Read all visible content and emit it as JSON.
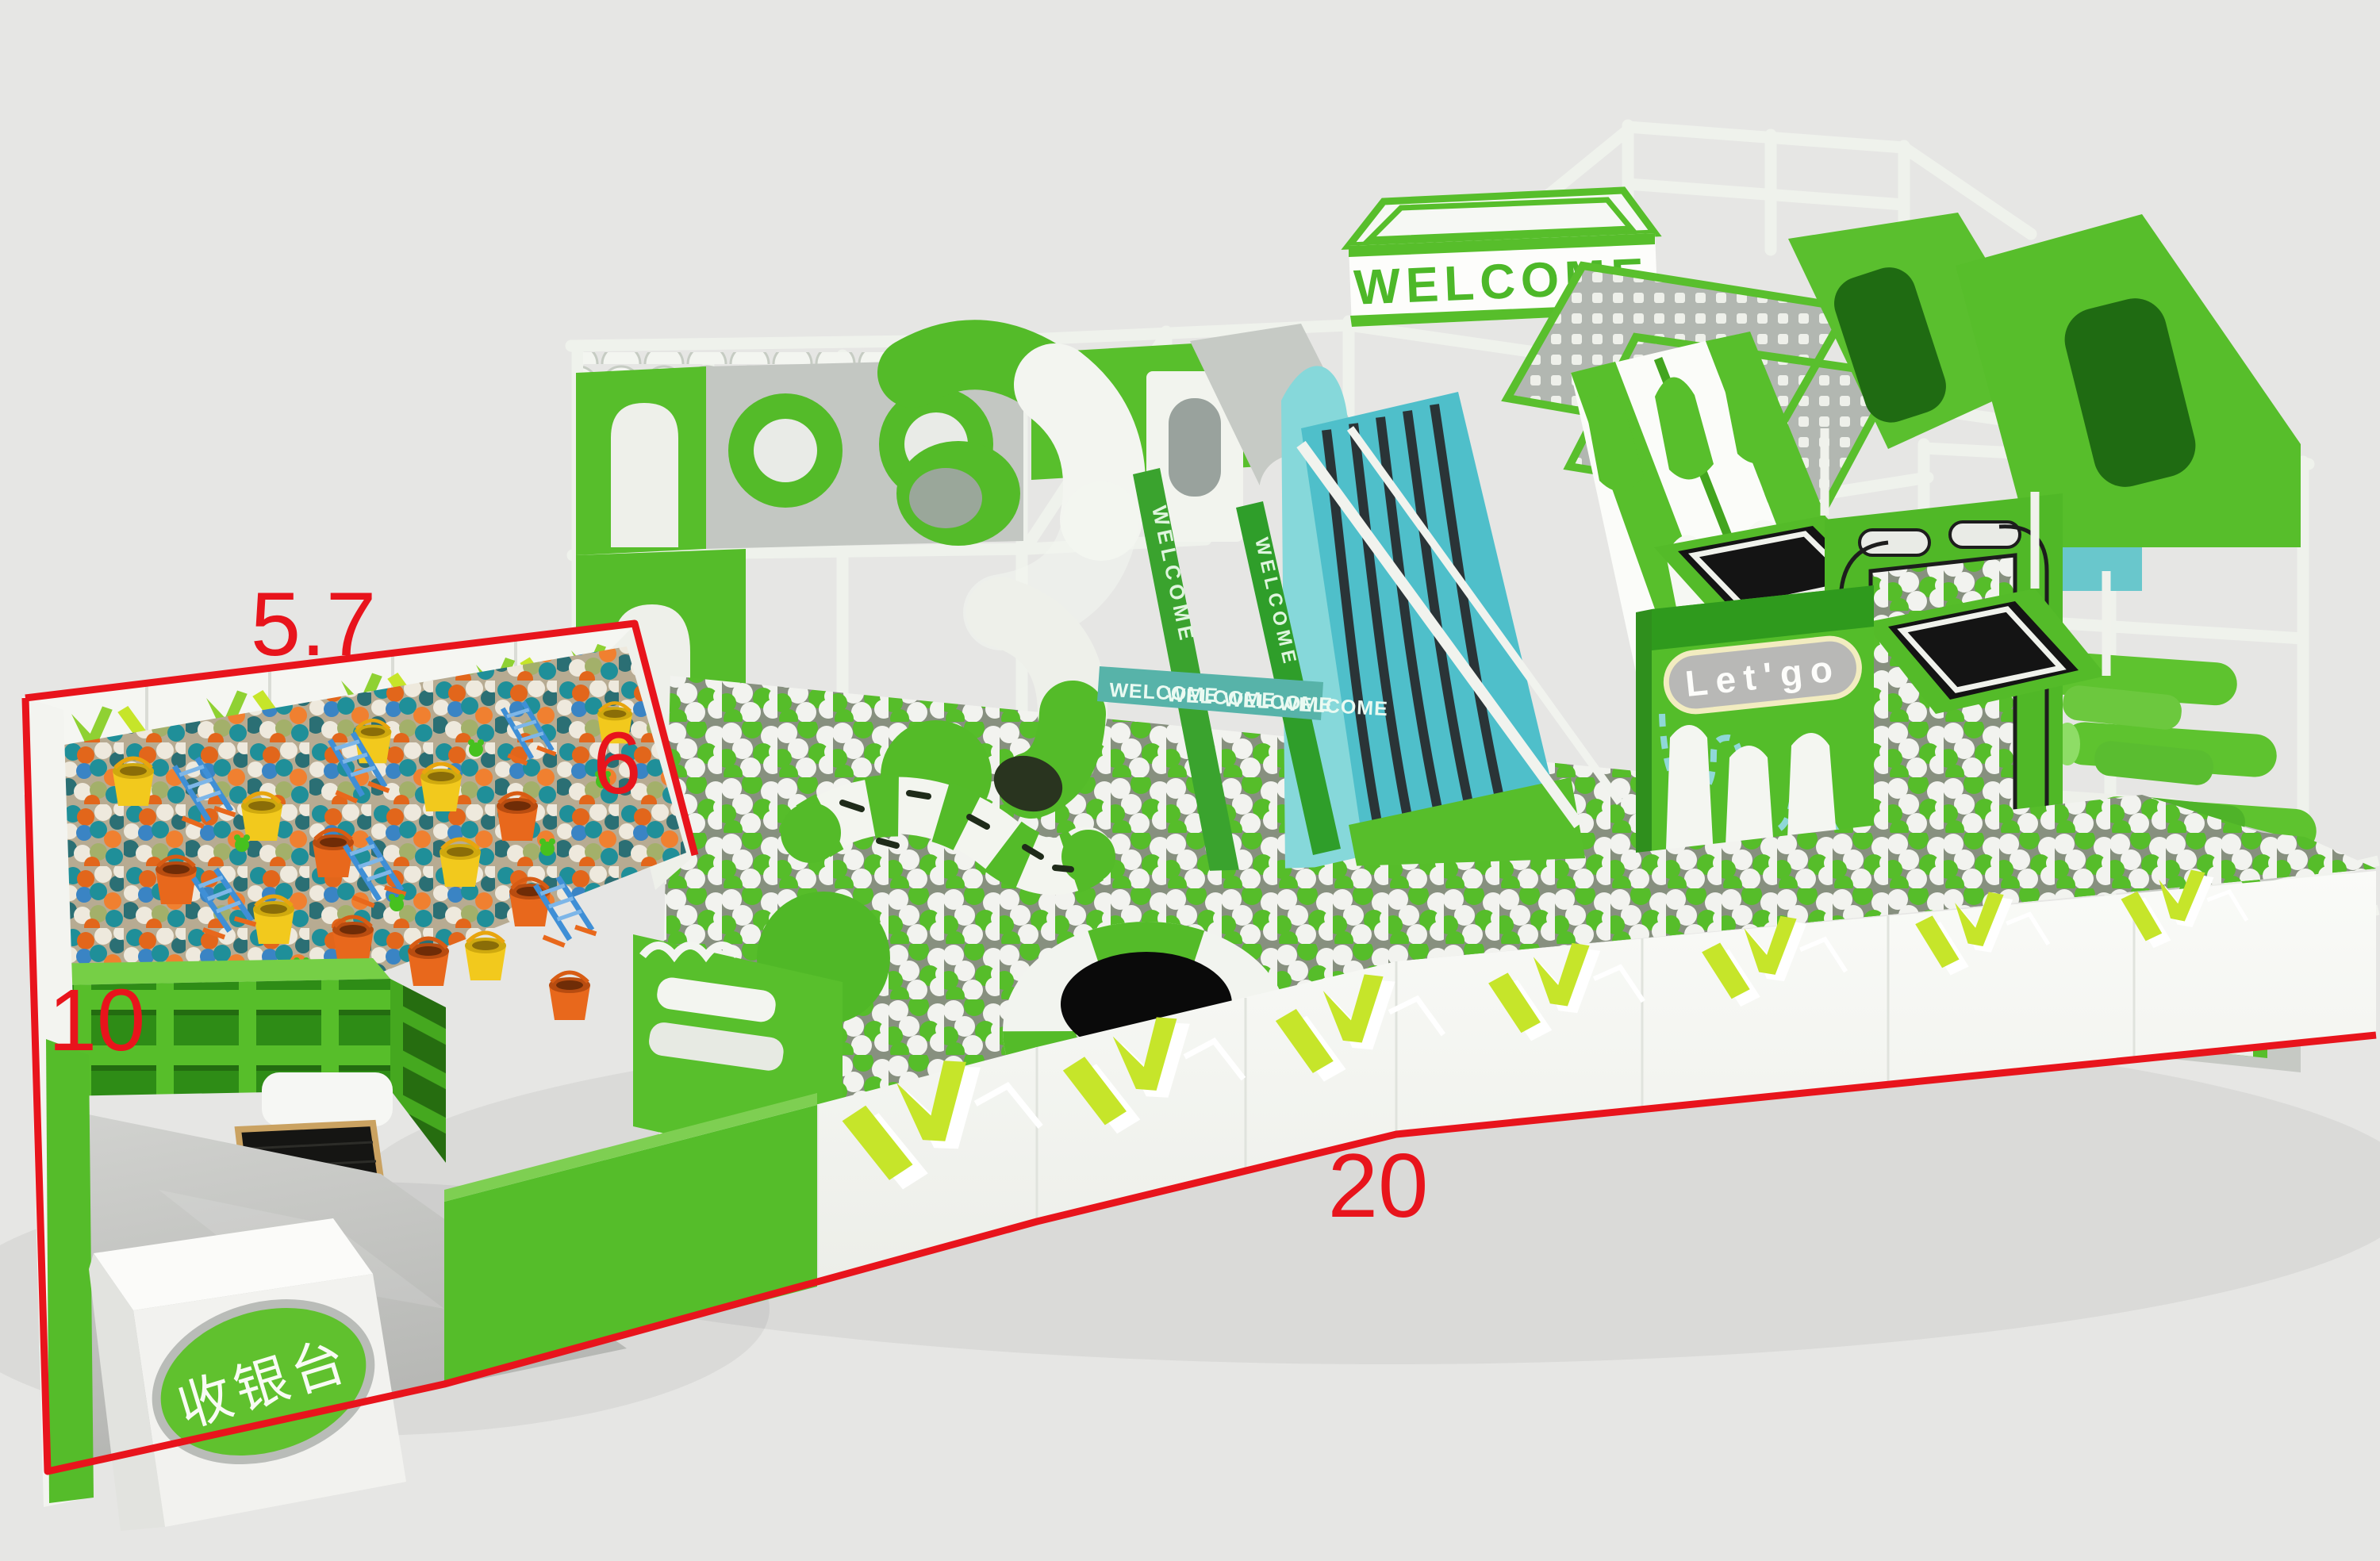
{
  "scene": {
    "description": "3D render of a green and white indoor playground with ball pits, slides, trampolines and a cashier corner",
    "background_color": "#e6e6e4"
  },
  "signs": {
    "welcome_main": "WELCOME",
    "welcome_banner": [
      "WELCOME",
      "WELCOME",
      "WELCOME",
      "WELCOME"
    ],
    "welcome_strap": "WELCOME",
    "letgo": "Let'go",
    "cashier": "收银台"
  },
  "dimensions": {
    "top": "5.7",
    "right": "6",
    "left": "10",
    "bottom": "20",
    "line_color": "#e8141c"
  },
  "palette": {
    "structure_green": "#57be2b",
    "dark_green": "#2f9119",
    "lime_chevron": "#c6e52a",
    "frame_white": "#f1f3ee",
    "gray_panel": "#c2c6c1",
    "teal_slide": "#4fbfca",
    "banner_teal": "#57b3a9",
    "ball_white": "#f2f3ef",
    "ball_green": "#56bd2a",
    "pit_teal": "#1f8f99",
    "pit_orange": "#e2661b",
    "bucket_yellow": "#f2c91d",
    "sign_pill_gray": "#b8b8b6",
    "trampoline_black": "#141414"
  }
}
